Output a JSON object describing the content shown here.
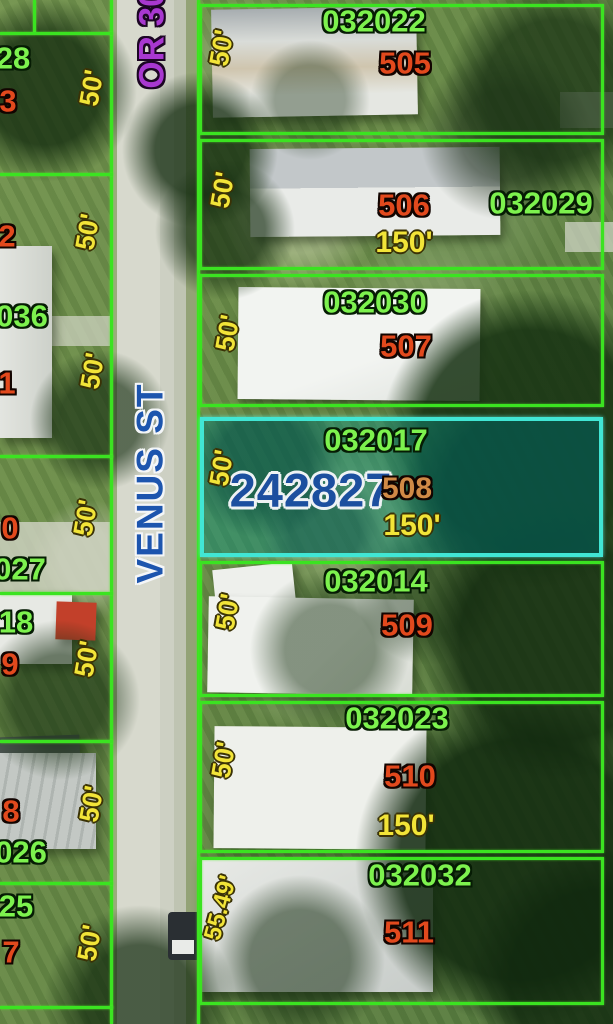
{
  "map_title": "Aerial parcel map - Venus St",
  "colors": {
    "boundary_green": "#3be321",
    "highlight_cyan": "#41e6d4",
    "parcel_id_green": "#7df24e",
    "lot_number_red": "#e2491d",
    "selected_lot_tan": "#d08a46",
    "dimension_yellow": "#f2e438",
    "street_blue": "#1d55ae",
    "selected_number_blue": "#1c4f9f",
    "route_purple": "#a838d0"
  },
  "streets": {
    "vertical_street": "VENUS ST",
    "top_route": "OR 30"
  },
  "selected_parcel": {
    "id": "032017",
    "number": "242827",
    "lot": "508",
    "width": "50'",
    "depth": "150'"
  },
  "parcels": [
    {
      "id": "032022",
      "lot": "505",
      "width": "50'"
    },
    {
      "id": "032029",
      "lot": "506",
      "width": "50'",
      "depth": "150'"
    },
    {
      "id": "032030",
      "lot": "507",
      "width": "50'"
    },
    {
      "id": "032014",
      "lot": "509",
      "width": "50'"
    },
    {
      "id": "032023",
      "lot": "510",
      "width": "50'",
      "depth": "150'"
    },
    {
      "id": "032032",
      "lot": "511",
      "width": "55.49'"
    }
  ],
  "west_parcels": [
    {
      "id": "28",
      "lot": "3",
      "width": "50'"
    },
    {
      "lot": "2",
      "width": "50'"
    },
    {
      "id": "036",
      "lot": "1",
      "width": "50'"
    },
    {
      "id": "027",
      "lot": "0",
      "width": "50'"
    },
    {
      "id": "18",
      "lot": "9",
      "width": "50'"
    },
    {
      "id": "026",
      "lot": "8",
      "width": "50'"
    },
    {
      "id": "25",
      "lot": "7",
      "width": "50'"
    }
  ]
}
